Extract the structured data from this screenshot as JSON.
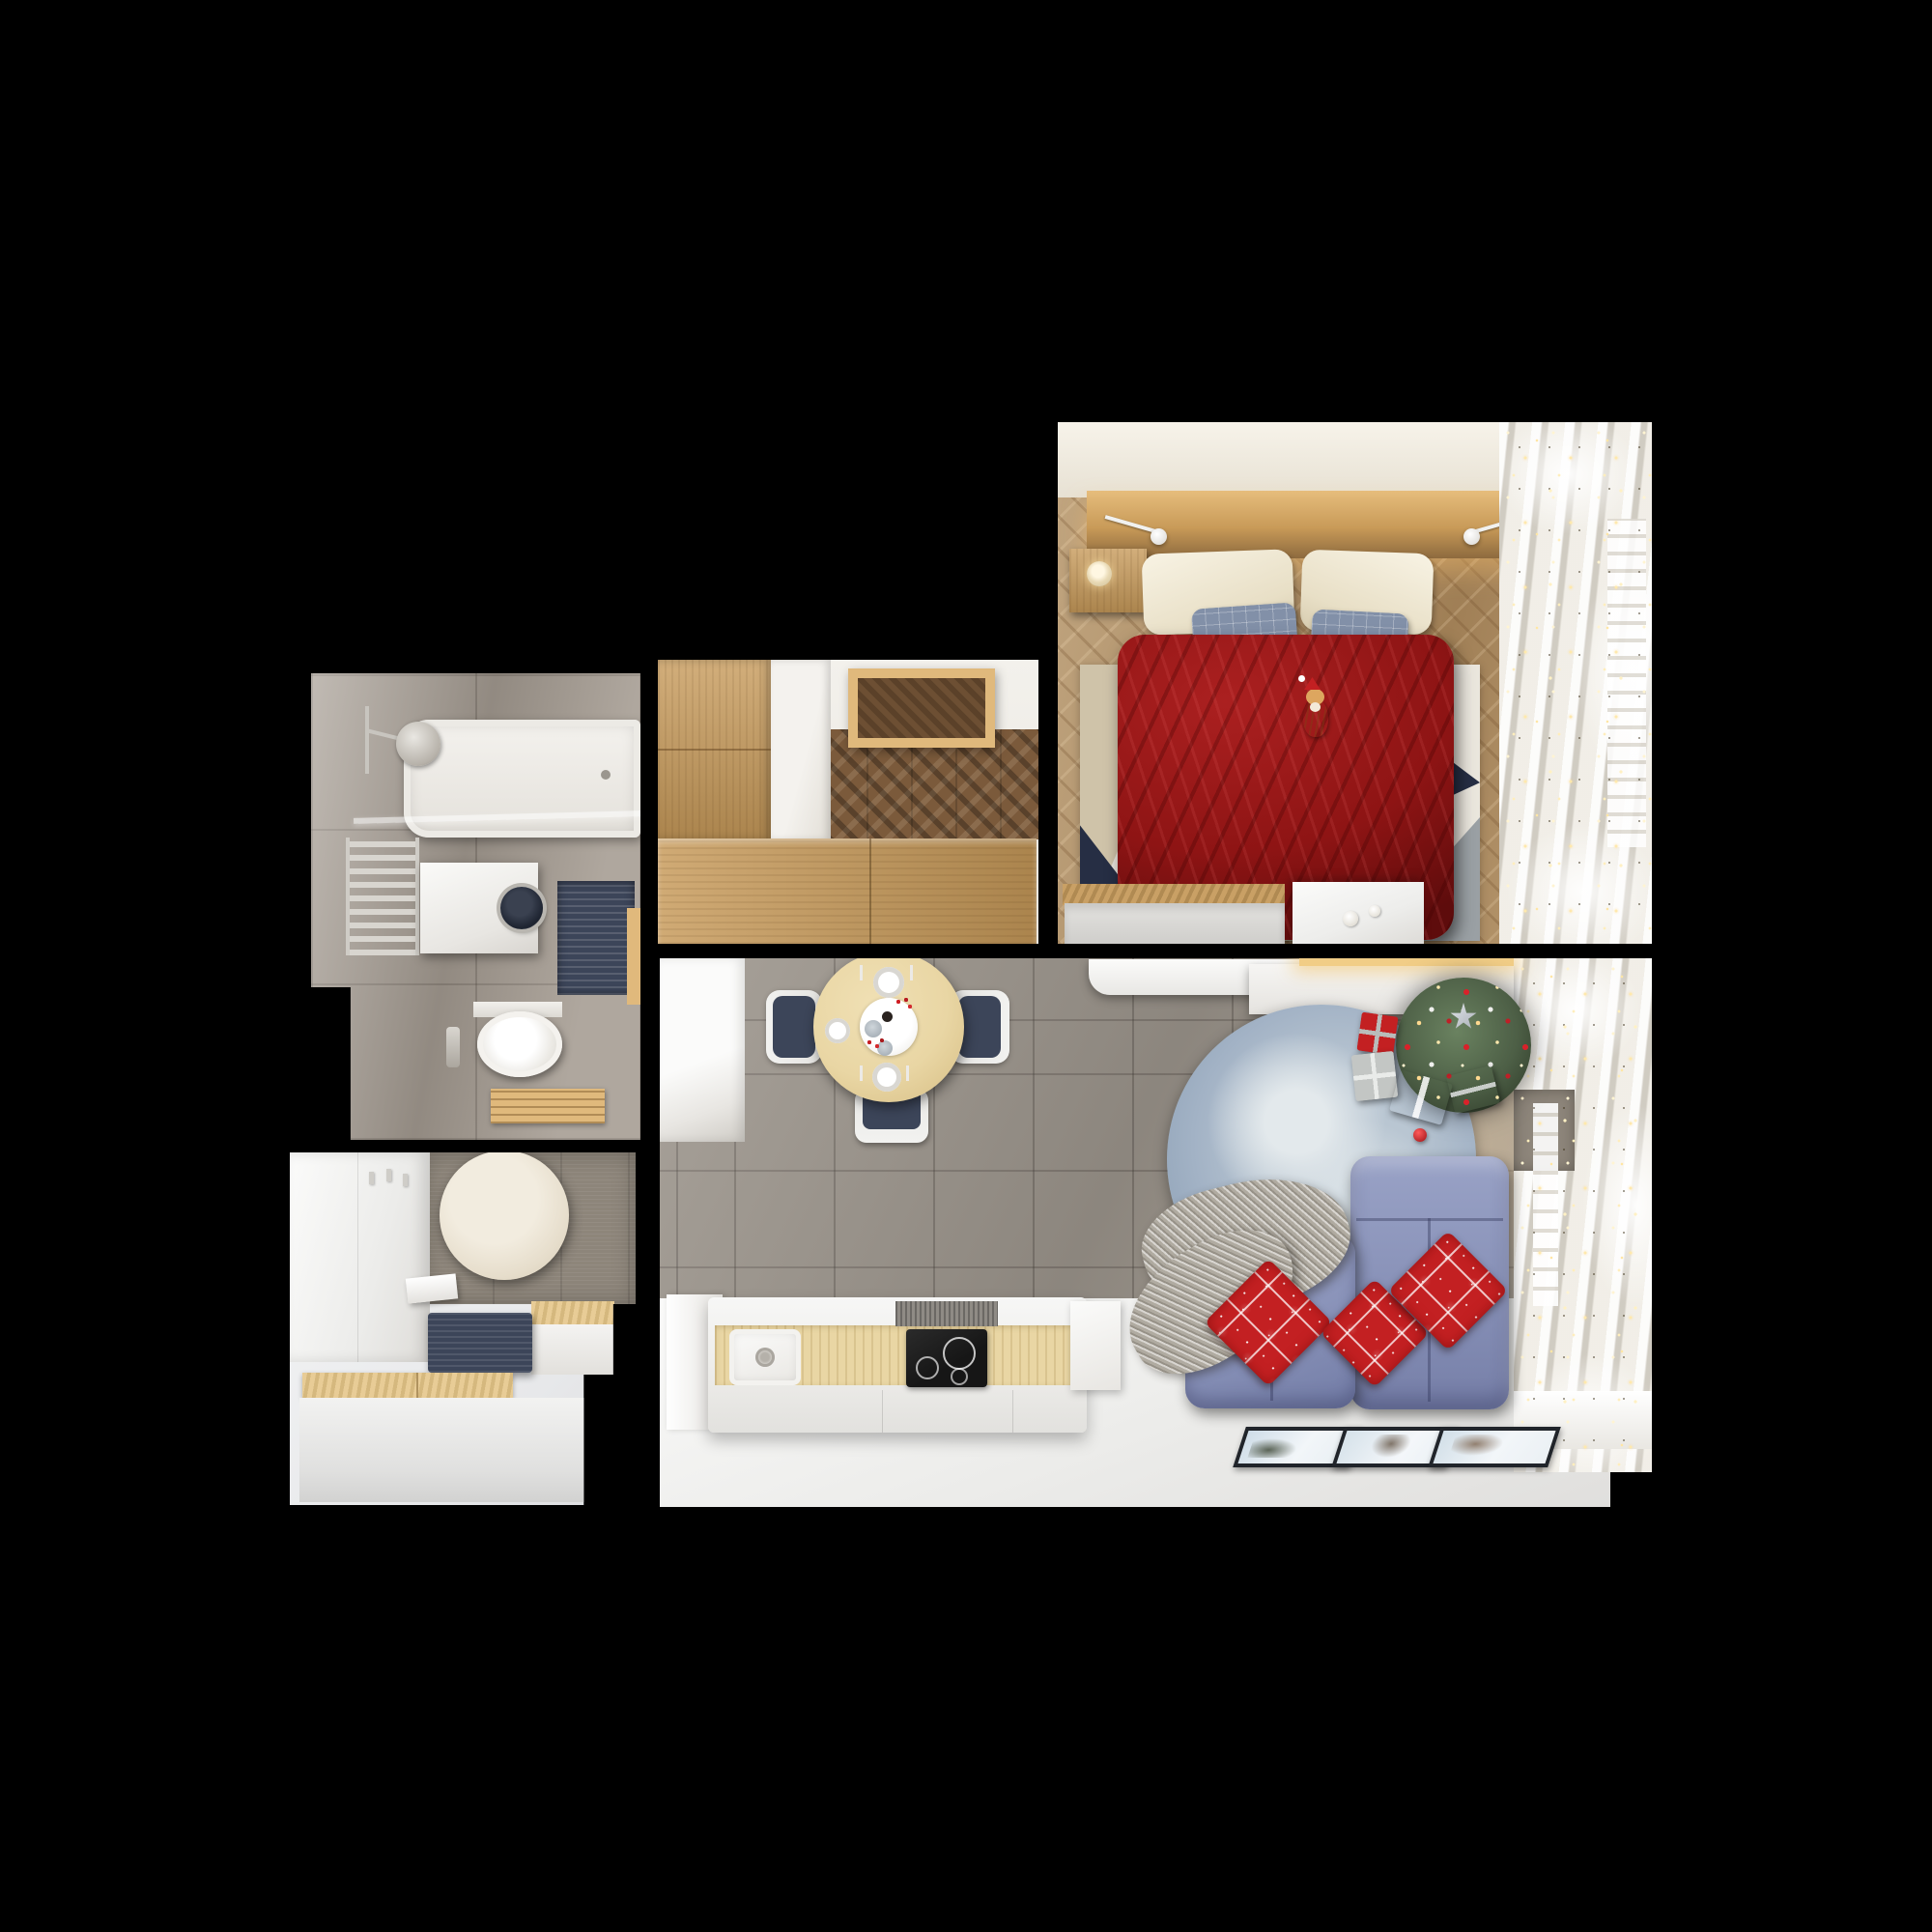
{
  "scene": {
    "kind": "apartment-floor-plan-3d-render",
    "view": "top-down",
    "theme": "christmas-decorated small apartment",
    "background": "#000000",
    "rooms": [
      {
        "name": "bedroom",
        "furniture": [
          "wood-headboard-shelf",
          "wall-lamp-left",
          "wall-lamp-right",
          "nightstand-with-candle",
          "double-bed",
          "cream-pillows",
          "blue-plaid-pillows",
          "red-velvet-duvet",
          "cat-with-santa-hat",
          "geometric-triangle-rug",
          "herringbone-wood-floor",
          "under-bed-drawer",
          "white-side-table-with-cups",
          "window-curtains",
          "string-lights"
        ]
      },
      {
        "name": "wardrobe-room",
        "furniture": [
          "oak-cabinet-left",
          "open-white-door",
          "oak-ceiling-light-box",
          "dark-chevron-parquet",
          "oak-wardrobe-bottom"
        ]
      },
      {
        "name": "bathroom",
        "furniture": [
          "bathtub",
          "shower-head",
          "glass-screen",
          "towel-radiator",
          "washing-machine",
          "navy-bath-mat",
          "wall-hung-toilet",
          "flush-plate",
          "wood-duckboard",
          "gray-stone-tiles"
        ]
      },
      {
        "name": "hallway",
        "furniture": [
          "white-wardrobe",
          "coat-hooks",
          "round-cream-mirror",
          "white-ledge",
          "navy-bench-cushion",
          "oak-bench-seats",
          "white-bench-base",
          "taupe-feature-wall"
        ]
      },
      {
        "name": "living-kitchen",
        "furniture": [
          "tall-white-cabinet",
          "round-dining-table",
          "place-settings",
          "red-berry-centerpiece",
          "navy-dining-chairs",
          "white-media-console",
          "under-shelf-gold-light",
          "christmas-tree-with-star",
          "gift-boxes",
          "round-blue-rug",
          "red-bauble",
          "gray-knit-throw",
          "periwinkle-corner-sofa",
          "red-snowflake-pillows",
          "three-floor-picture-frames",
          "kitchen-island",
          "inset-sink",
          "induction-hob",
          "gray-tile-floor",
          "white-floor",
          "window-curtains",
          "string-lights"
        ]
      }
    ]
  },
  "palette": {
    "bg": "#000000",
    "wall-cream": "#f1ebdf",
    "oak": "#c79a5a",
    "oak-light": "#e0b97c",
    "oak-dark": "#99713f",
    "floor-wood": "#b18f63",
    "walnut": "#7b5a3b",
    "maple": "#e9d6a4",
    "duvet-red": "#8e1414",
    "duvet-red-light": "#ab2020",
    "duvet-red-dark": "#5e0c0c",
    "pillow-cream": "#f1ead9",
    "pillow-blue": "#8290a8",
    "rug-navy": "#262e44",
    "rug-beige": "#cfc3a9",
    "rug-gray": "#9aa0a4",
    "rug-rose": "#b18a8a",
    "rug-white": "#eae6dd",
    "tile-gray": "#9c958c",
    "bath-tile": "#a69d93",
    "white-furn": "#f4f4f4",
    "navy": "#3c4559",
    "sofa-blue": "#8b94ba",
    "sofa-blue-dark": "#66719d",
    "rug-blue": "#a2b2c5",
    "throw-gray": "#b0aba1",
    "red": "#c32022",
    "tree-green": "#4d5f46",
    "gold": "#f1cd86",
    "chrome": "#c8c5bf",
    "cooktop-black": "#161616",
    "frame-black": "#20242a",
    "cat-orange": "#d09a55",
    "wall-taupe": "#8d857a"
  }
}
